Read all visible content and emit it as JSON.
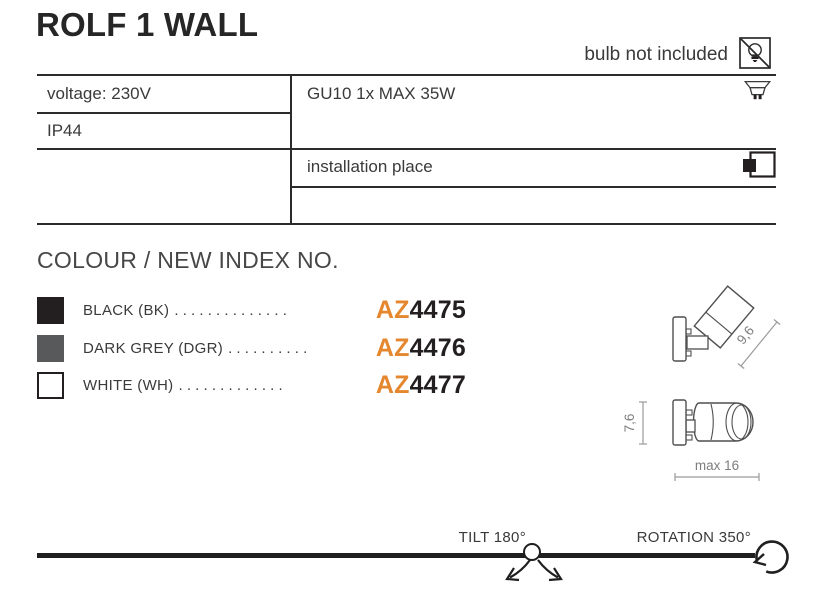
{
  "title": "ROLF 1 WALL",
  "bulb_note": {
    "text": "bulb not included",
    "icon": "bulb-crossed-icon"
  },
  "spec_table": {
    "voltage": "voltage: 230V",
    "ip_rating": "IP44",
    "bulb_spec": "GU10 1x MAX 35W",
    "installation_label": "installation place",
    "icons": {
      "bulb_spec": "gu10-socket-icon",
      "installation": "wall-mount-icon"
    }
  },
  "colour_section": {
    "heading": "COLOUR / NEW INDEX NO.",
    "rows": [
      {
        "swatch_color": "#231f20",
        "swatch_outlined": false,
        "label": "BLACK (BK)",
        "dots": ". . . . . . . . . . . . . .",
        "code_prefix": "AZ",
        "code_number": "4475"
      },
      {
        "swatch_color": "#58595b",
        "swatch_outlined": false,
        "label": "DARK GREY (DGR)",
        "dots": ". . . . . . . . . .",
        "code_prefix": "AZ",
        "code_number": "4476"
      },
      {
        "swatch_color": "#ffffff",
        "swatch_outlined": true,
        "label": "WHITE (WH)",
        "dots": ". . . . . . . . . . . . .",
        "code_prefix": "AZ",
        "code_number": "4477"
      }
    ]
  },
  "drawing": {
    "dim_depth": "9,6",
    "dim_height": "7,6",
    "dim_width": "max 16"
  },
  "motion": {
    "tilt_label": "TILT 180°",
    "rotation_label": "ROTATION 350°"
  },
  "colors": {
    "accent": "#e5872e",
    "text": "#3a3a3a",
    "line": "#2b2b2b",
    "dim": "#7d7d7d",
    "swatch_black": "#231f20",
    "swatch_dark_grey": "#58595b"
  }
}
